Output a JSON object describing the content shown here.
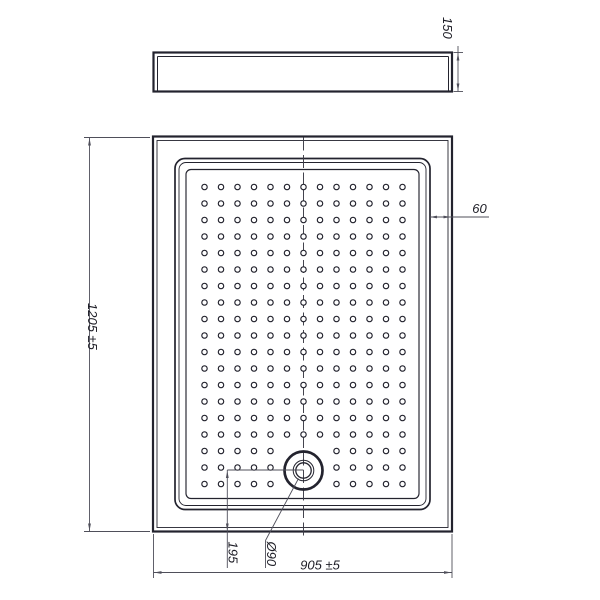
{
  "drawing": {
    "kind": "shower-tray-technical-drawing",
    "labels": {
      "side_height": "150",
      "length": "1205 ±5",
      "rim_width": "60",
      "drain_offset_bottom": "195",
      "drain_diameter": "Ø90",
      "width": "905 ±5"
    },
    "colors": {
      "line": "#23232e",
      "dimension": "#4f4f5a",
      "text": "#1d1d26",
      "background": "#ffffff"
    },
    "dot_grid": {
      "cols": 13,
      "rows": 19,
      "x0": 204.5,
      "y0": 187,
      "spacing_x": 16.5,
      "spacing_y": 16.5,
      "dot_radius": 2.7,
      "skip_center_x": 303.5,
      "skip_center_y": 470.5,
      "skip_radius": 30
    },
    "drain": {
      "cx": 303.5,
      "cy": 470.5,
      "outer_r": 19,
      "mid_r": 10.3,
      "inner_r": 7.7
    }
  }
}
